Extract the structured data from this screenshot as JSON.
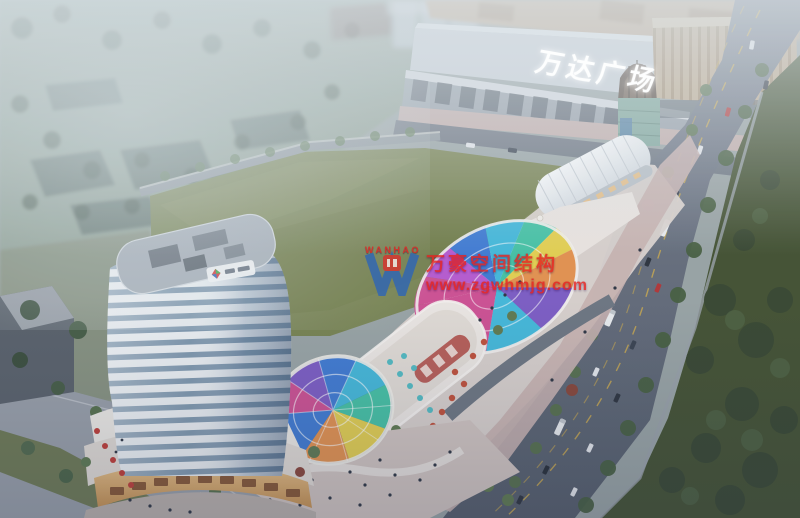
{
  "mall": {
    "sign_text": "万达广场"
  },
  "watermark": {
    "brand_cn": "万豪空间结构",
    "website": "www.zgwhmjg.com",
    "logo_text": "WANHAO",
    "text_color": "#e42320",
    "logo_blue": "#2f66b5",
    "badge_red": "#d8332e"
  },
  "palette": {
    "haze": "#b9c3c4",
    "lawn": "#78834f",
    "dark_green": "#42502f",
    "road": "#6b7380",
    "tower_band_white": "#eef2f4",
    "tower_glass": "#8099ae",
    "podium_glow": "#dfae72",
    "umbrella_teal": "#52bcc2",
    "umbrella_red": "#c14f38",
    "sidewalk_pink": "#c6b0ac",
    "canopy": [
      "#d04f92",
      "#7d5cc4",
      "#3f7bd3",
      "#43b9da",
      "#45c3a4",
      "#e6d14e",
      "#e6924d",
      "#b85ad0"
    ]
  }
}
